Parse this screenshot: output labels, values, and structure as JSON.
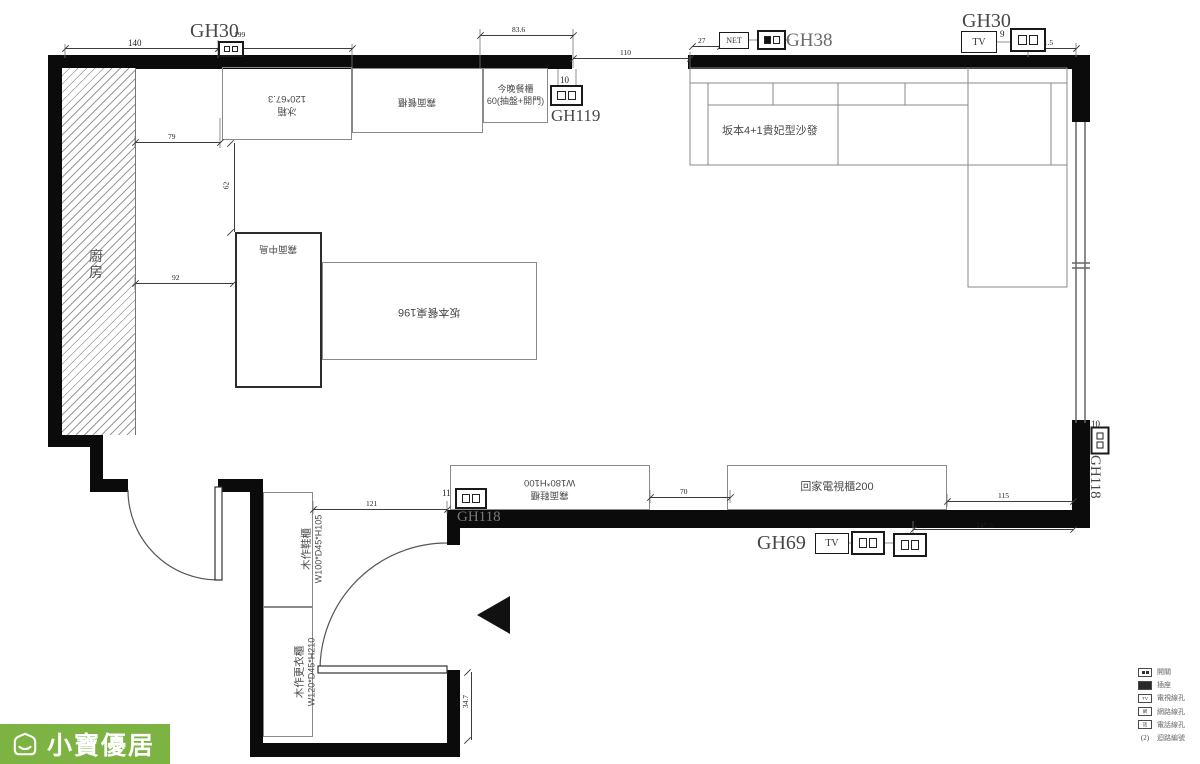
{
  "plan": {
    "markers": {
      "gh30_left": "GH30",
      "gh119": "GH119",
      "gh38": "GH38",
      "gh30_right": "GH30",
      "gh69": "GH69",
      "gh118_wall": "GH118",
      "gh118_side": "GH118"
    },
    "rooms": {
      "kitchen": "廚房"
    },
    "furniture": {
      "fridge_name": "冰箱",
      "fridge_size": "120*67.3",
      "matte_dining_cabinet": "霧面餐櫃",
      "tonight_cabinet_name": "今晚餐櫃",
      "tonight_cabinet_size": "60(抽盤+開門)",
      "sofa": "坂本4+1貴妃型沙發",
      "matte_island": "霧面中島",
      "dining_table": "坂本餐桌196",
      "entry_cabinet_name": "霧面鞋櫃",
      "entry_cabinet_size": "W180*H100",
      "tv_cabinet": "回家電視櫃200",
      "shoe_cabinet_name": "木作鞋櫃",
      "shoe_cabinet_size": "W100*D45*H105",
      "wardrobe_name": "木作更衣櫃",
      "wardrobe_size": "W120*D45*H210"
    },
    "ports_text": {
      "net": "NET",
      "tv": "TV"
    },
    "dimensions": [
      {
        "value": "140",
        "type": "h",
        "x1": 65,
        "x2": 218,
        "y": 48,
        "lx": 128,
        "ly": 38
      },
      {
        "value": "199",
        "type": "h",
        "x1": 218,
        "x2": 352,
        "y": 48,
        "lx": 234,
        "ly": 30,
        "small": true
      },
      {
        "value": "83.6",
        "type": "h",
        "x1": 480,
        "x2": 573,
        "y": 35,
        "lx": 512,
        "ly": 25,
        "small": true
      },
      {
        "value": "110",
        "type": "h",
        "x1": 573,
        "x2": 690,
        "y": 58,
        "lx": 620,
        "ly": 48,
        "small": true
      },
      {
        "value": "27",
        "type": "h",
        "x1": 692,
        "x2": 720,
        "y": 46,
        "lx": 698,
        "ly": 36,
        "small": true
      },
      {
        "value": "41.5",
        "type": "h",
        "x1": 1028,
        "x2": 1076,
        "y": 48,
        "lx": 1040,
        "ly": 38,
        "small": true
      },
      {
        "value": "79",
        "type": "h",
        "x1": 135,
        "x2": 220,
        "y": 142,
        "lx": 168,
        "ly": 132,
        "small": true
      },
      {
        "value": "92",
        "type": "h",
        "x1": 135,
        "x2": 233,
        "y": 283,
        "lx": 172,
        "ly": 273,
        "small": true
      },
      {
        "value": "62",
        "type": "v",
        "x": 234,
        "y1": 143,
        "y2": 232,
        "lx": 222,
        "ly": 181,
        "small": true
      },
      {
        "value": "121",
        "type": "h",
        "x1": 313,
        "x2": 447,
        "y": 509,
        "lx": 366,
        "ly": 499,
        "small": true
      },
      {
        "value": "70",
        "type": "h",
        "x1": 650,
        "x2": 730,
        "y": 497,
        "lx": 680,
        "ly": 487,
        "small": true
      },
      {
        "value": "115",
        "type": "h",
        "x1": 947,
        "x2": 1073,
        "y": 501,
        "lx": 998,
        "ly": 491,
        "small": true
      },
      {
        "value": "147.5",
        "type": "h",
        "x1": 913,
        "x2": 1073,
        "y": 529,
        "lx": 976,
        "ly": 521,
        "small": true
      },
      {
        "value": "34.7",
        "type": "v",
        "x": 471,
        "y1": 672,
        "y2": 740,
        "lx": 459,
        "ly": 697,
        "small": true
      },
      {
        "value": "9",
        "type": "t",
        "lx": 1000,
        "ly": 29
      },
      {
        "value": "10",
        "type": "t",
        "lx": 560,
        "ly": 75
      },
      {
        "value": "11",
        "type": "t",
        "lx": 442,
        "ly": 488
      },
      {
        "value": "7",
        "type": "t",
        "lx": 844,
        "ly": 534
      },
      {
        "value": "8",
        "type": "t",
        "lx": 878,
        "ly": 534
      },
      {
        "value": "10",
        "type": "t",
        "lx": 1091,
        "ly": 419
      }
    ],
    "ports": [
      {
        "type": "outlet",
        "name": "outlet-icon",
        "x": 218,
        "y": 41,
        "w": 26,
        "h": 16
      },
      {
        "type": "outlet",
        "name": "outlet-icon",
        "x": 550,
        "y": 85,
        "w": 33,
        "h": 21
      },
      {
        "type": "net",
        "name": "net-jack-icon",
        "x": 719,
        "y": 32,
        "w": 30,
        "h": 17,
        "text": "NET",
        "fs": 8
      },
      {
        "type": "outlet_f",
        "name": "outlet-switch-icon",
        "x": 757,
        "y": 30,
        "w": 29,
        "h": 20
      },
      {
        "type": "tv",
        "name": "tv-jack-icon",
        "x": 961,
        "y": 31,
        "w": 36,
        "h": 22,
        "text": "TV",
        "fs": 10
      },
      {
        "type": "outlet",
        "name": "outlet-icon",
        "x": 1010,
        "y": 28,
        "w": 36,
        "h": 24
      },
      {
        "type": "outlet",
        "name": "outlet-icon",
        "x": 455,
        "y": 488,
        "w": 32,
        "h": 21
      },
      {
        "type": "tv",
        "name": "tv-jack-icon",
        "x": 815,
        "y": 533,
        "w": 34,
        "h": 21,
        "text": "TV",
        "fs": 10
      },
      {
        "type": "outlet",
        "name": "outlet-icon",
        "x": 851,
        "y": 531,
        "w": 34,
        "h": 24
      },
      {
        "type": "outlet",
        "name": "outlet-icon",
        "x": 893,
        "y": 533,
        "w": 34,
        "h": 24
      },
      {
        "type": "outlet",
        "name": "outlet-icon",
        "x": 1086,
        "y": 431,
        "w": 28,
        "h": 19,
        "rot": 90
      }
    ],
    "legend": {
      "rows": [
        {
          "icon": "switch-icon",
          "style": "squares",
          "label": "開關"
        },
        {
          "icon": "outlet-icon",
          "style": "solid",
          "label": "插座"
        },
        {
          "icon": "tv-jack-icon",
          "style": "tag",
          "tag": "TV",
          "label": "電視線孔"
        },
        {
          "icon": "net-jack-icon",
          "style": "tag",
          "tag": "網",
          "label": "網路線孔"
        },
        {
          "icon": "phone-jack-icon",
          "style": "tag",
          "tag": "話",
          "label": "電話線孔"
        },
        {
          "icon": "circuit-count",
          "style": "none",
          "tag": "(2)",
          "label": "迴路編號"
        }
      ]
    },
    "logo": {
      "text": "小寶優居",
      "bg_color": "#7cb342"
    }
  }
}
